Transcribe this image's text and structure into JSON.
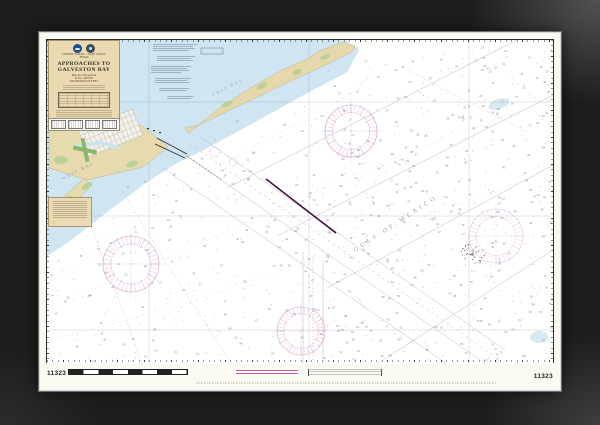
{
  "chart": {
    "number": "11323",
    "country_line": "UNITED STATES – GULF COAST",
    "state_line": "TEXAS",
    "title_line1": "APPROACHES TO",
    "title_line2": "GALVESTON BAY",
    "projection_line": "Mercator Projection",
    "scale_line": "Scale 1:80,000",
    "soundings_line": "SOUNDINGS IN FEET",
    "place_labels": {
      "gulf": "GULF OF MEXICO",
      "west_bay": "WEST BAY",
      "east_bay": "EAST BAY"
    },
    "colors": {
      "frame": "#1d1d1d",
      "paper": "#fbfaf2",
      "land": "#e7daae",
      "marsh": "#b9d096",
      "shallow_water": "#cfe6f2",
      "magenta": "#c060a0",
      "fairway_purple": "#41103d",
      "lane_gray": "#b6a8b4"
    }
  }
}
